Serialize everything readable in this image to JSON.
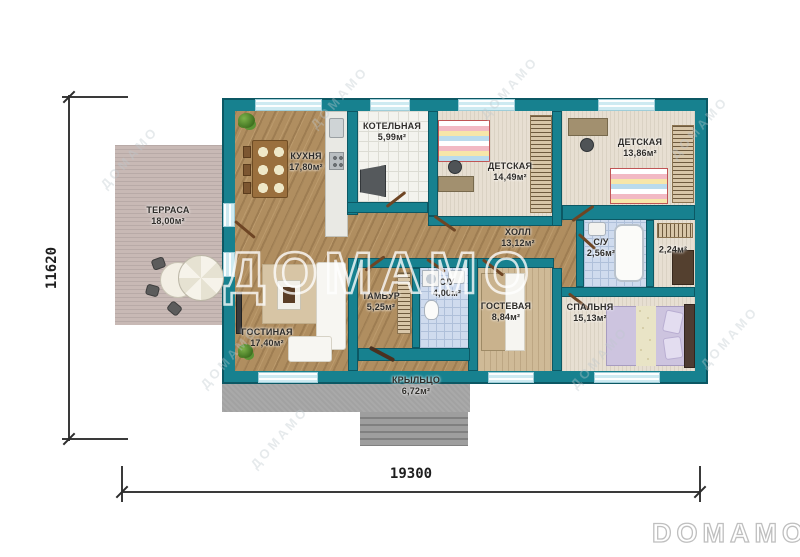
{
  "plan": {
    "dimension_width": "19300",
    "dimension_height": "11620",
    "watermark_text": "ДОМАМО",
    "logo_text": "DOMAMO",
    "rooms": {
      "terrace": {
        "name": "ТЕРРАСА",
        "area": "18,00м²"
      },
      "kitchen": {
        "name": "КУХНЯ",
        "area": "17,80м²"
      },
      "boiler": {
        "name": "КОТЕЛЬНАЯ",
        "area": "5,99м²"
      },
      "kids1": {
        "name": "ДЕТСКАЯ",
        "area": "14,49м²"
      },
      "kids2": {
        "name": "ДЕТСКАЯ",
        "area": "13,86м²"
      },
      "hall": {
        "name": "ХОЛЛ",
        "area": "13,12м²"
      },
      "bath_small": {
        "name": "С/У",
        "area": "2,56м²"
      },
      "closet": {
        "name": "",
        "area": "2,24м²"
      },
      "vestibule": {
        "name": "ТАМБУР",
        "area": "5,25м²"
      },
      "bath_main": {
        "name": "С/У",
        "area": "4,00м²"
      },
      "guest": {
        "name": "ГОСТЕВАЯ",
        "area": "8,84м²"
      },
      "bedroom": {
        "name": "СПАЛЬНЯ",
        "area": "15,13м²"
      },
      "living": {
        "name": "ГОСТИНАЯ",
        "area": "17,40м²"
      },
      "porch": {
        "name": "КРЫЛЬЦО",
        "area": "6,72м²"
      }
    },
    "colors": {
      "wall": "#17818f",
      "wood_floor": "#b08e60",
      "carpet": "#e7dfd2",
      "tile_blue": "#cfdbee",
      "tile_white": "#f3f3ee",
      "terrace": "#c8b9b5",
      "porch": "#a2a2a2",
      "window_glass": "#cdeaf1"
    }
  }
}
